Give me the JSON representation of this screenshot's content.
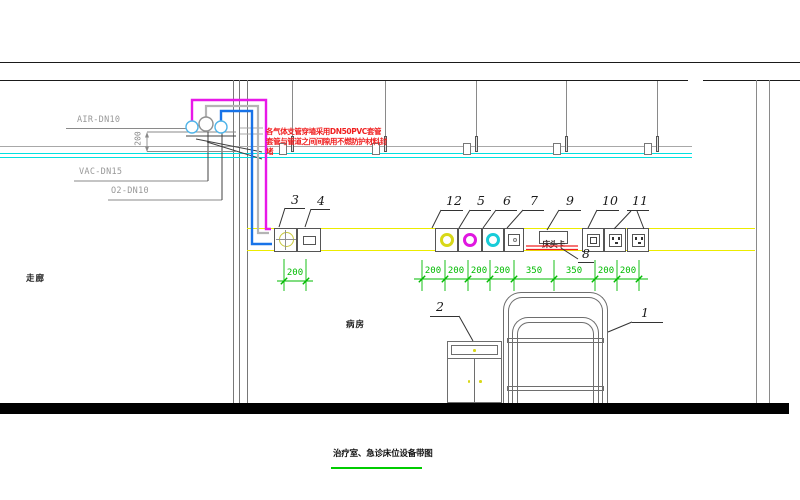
{
  "drawing_title": {
    "text": "治疗室、急诊床位设备带图"
  },
  "room_labels": {
    "corridor": "走廊",
    "ward": "病房"
  },
  "pipe_labels": {
    "air": "AIR-DN10",
    "vac": "VAC-DN15",
    "o2": "O2-DN10"
  },
  "annotation_note": {
    "line1": "各气体支管穿墙采用DN50PVC套管",
    "line2": "套管与管道之间间隙用不燃防护材料封",
    "line3": "堵"
  },
  "bed_head_card": {
    "text": "床头卡"
  },
  "dimensions": {
    "left_riser": "200",
    "device3_offset": "200",
    "chain": [
      "200",
      "200",
      "200",
      "200",
      "350",
      "350",
      "200",
      "200"
    ]
  },
  "callouts": [
    {
      "num": "3",
      "tx": 291,
      "ty": 194,
      "u": [
        285,
        305,
        208
      ],
      "l": [
        [
          285,
          208,
          279,
          227
        ]
      ]
    },
    {
      "num": "4",
      "tx": 317,
      "ty": 195,
      "u": [
        311,
        330,
        209
      ],
      "l": [
        [
          311,
          209,
          305,
          227
        ]
      ]
    },
    {
      "num": "12",
      "tx": 446,
      "ty": 195,
      "u": [
        441,
        463,
        210
      ],
      "l": [
        [
          441,
          210,
          432,
          228
        ]
      ]
    },
    {
      "num": "5",
      "tx": 477,
      "ty": 195,
      "u": [
        470,
        491,
        210
      ],
      "l": [
        [
          470,
          210,
          459,
          228
        ]
      ]
    },
    {
      "num": "6",
      "tx": 503,
      "ty": 195,
      "u": [
        496,
        517,
        210
      ],
      "l": [
        [
          496,
          210,
          483,
          228
        ]
      ]
    },
    {
      "num": "7",
      "tx": 530,
      "ty": 195,
      "u": [
        523,
        544,
        210
      ],
      "l": [
        [
          523,
          210,
          507,
          228
        ]
      ]
    },
    {
      "num": "9",
      "tx": 566,
      "ty": 195,
      "u": [
        559,
        581,
        210
      ],
      "l": [
        [
          559,
          210,
          547,
          230
        ]
      ]
    },
    {
      "num": "10",
      "tx": 602,
      "ty": 195,
      "u": [
        597,
        619,
        210
      ],
      "l": [
        [
          597,
          210,
          588,
          228
        ]
      ]
    },
    {
      "num": "11",
      "tx": 632,
      "ty": 195,
      "u": [
        627,
        649,
        210
      ],
      "l": [
        [
          631,
          211,
          614,
          229
        ],
        [
          637,
          211,
          644,
          229
        ]
      ]
    },
    {
      "num": "8",
      "tx": 582,
      "ty": 248,
      "u": [
        578,
        594,
        262
      ],
      "l": [
        [
          561,
          248,
          578,
          259
        ]
      ]
    },
    {
      "num": "2",
      "tx": 436,
      "ty": 301,
      "u": [
        430,
        459,
        316
      ],
      "l": [
        [
          459,
          316,
          473,
          341
        ]
      ]
    },
    {
      "num": "1",
      "tx": 641,
      "ty": 307,
      "u": [
        632,
        663,
        322
      ],
      "l": [
        [
          632,
          322,
          608,
          332
        ]
      ]
    }
  ],
  "geometry": {
    "hangers_x": [
      292,
      385,
      476,
      566,
      657
    ],
    "band": {
      "y": 228,
      "h": 23.5,
      "x1": 247,
      "x2": 755
    },
    "devices": [
      {
        "id": "3",
        "x": 274,
        "w": 23,
        "type": "cross_circle"
      },
      {
        "id": "4",
        "x": 297,
        "w": 24,
        "type": "blank_plate"
      },
      {
        "id": "12",
        "x": 435,
        "w": 23,
        "type": "ring",
        "color": "#d8d818"
      },
      {
        "id": "5",
        "x": 458,
        "w": 24,
        "type": "ring",
        "color": "#e018e0"
      },
      {
        "id": "6",
        "x": 482,
        "w": 22,
        "type": "ring",
        "color": "#18ccd8"
      },
      {
        "id": "7",
        "x": 504,
        "w": 20,
        "type": "button_plate"
      },
      {
        "id": "10",
        "x": 582,
        "w": 22,
        "type": "double_square"
      },
      {
        "id": "11a",
        "x": 604,
        "w": 22,
        "type": "socket"
      },
      {
        "id": "11b",
        "x": 627,
        "w": 22,
        "type": "socket"
      }
    ],
    "chain": {
      "y": 279,
      "x1": 414,
      "x2": 648,
      "ticks": [
        422,
        445,
        468,
        490,
        514,
        554,
        595,
        617,
        639
      ],
      "label_x": [
        433,
        456,
        479,
        502,
        534,
        574,
        606,
        628
      ],
      "label_y": 266
    },
    "small_dim": {
      "y": 281,
      "x1": 277,
      "x2": 313,
      "ticks": [
        284,
        306
      ],
      "label_x": 295,
      "label_y": 268
    },
    "pipes": [
      {
        "id": "gray",
        "pts": [
          [
            206,
            117
          ],
          [
            206,
            106
          ],
          [
            258,
            106
          ],
          [
            258,
            233
          ],
          [
            269,
            233
          ]
        ],
        "c": "#b4b4b4",
        "w": 2.2
      },
      {
        "id": "blue",
        "pts": [
          [
            221,
            122
          ],
          [
            221,
            111
          ],
          [
            252,
            111
          ],
          [
            252,
            244
          ],
          [
            272,
            244
          ]
        ],
        "c": "#1873e8",
        "w": 2.4
      },
      {
        "id": "magenta",
        "pts": [
          [
            192,
            122
          ],
          [
            192,
            100
          ],
          [
            266,
            100
          ],
          [
            266,
            229
          ],
          [
            271,
            229
          ]
        ],
        "c": "#e818e8",
        "w": 2.4
      }
    ],
    "outlets": [
      {
        "cx": 192,
        "cy": 127,
        "r": 6,
        "c": "#50b4e8"
      },
      {
        "cx": 206,
        "cy": 124,
        "r": 7,
        "c": "#909090"
      },
      {
        "cx": 221,
        "cy": 127,
        "r": 6,
        "c": "#50b4e8"
      }
    ],
    "lines": [
      [
        66,
        128.5,
        190,
        128.5,
        "g",
        1
      ],
      [
        147,
        132,
        236,
        132,
        "g",
        0.9
      ],
      [
        186,
        136,
        236,
        136,
        "k",
        1
      ],
      [
        74,
        181,
        208,
        181,
        "g",
        1
      ],
      [
        208,
        181,
        208,
        132,
        "k",
        1
      ],
      [
        108,
        200,
        222,
        200,
        "g",
        1
      ],
      [
        222,
        200,
        222,
        133,
        "k",
        1
      ],
      [
        196,
        139,
        262,
        152,
        "k",
        1
      ],
      [
        207,
        142,
        262,
        159,
        "k",
        1
      ],
      [
        240,
        128,
        263,
        128,
        "lg",
        0.9
      ],
      [
        240,
        134,
        263,
        134,
        "lg",
        0.9
      ],
      [
        147,
        133,
        147,
        151,
        "g",
        0.9
      ],
      [
        147,
        151.5,
        236,
        151.5,
        "g",
        0.9
      ],
      [
        526,
        246,
        578,
        246,
        "red",
        1.3
      ],
      [
        526,
        249.5,
        578,
        249.5,
        "red",
        1.3
      ]
    ],
    "arrows": [
      {
        "pts": "147,132 145,137.5 149,137.5",
        "c": "#8a8a8a"
      },
      {
        "pts": "147,152 145,146.5 149,146.5",
        "c": "#8a8a8a"
      }
    ]
  }
}
